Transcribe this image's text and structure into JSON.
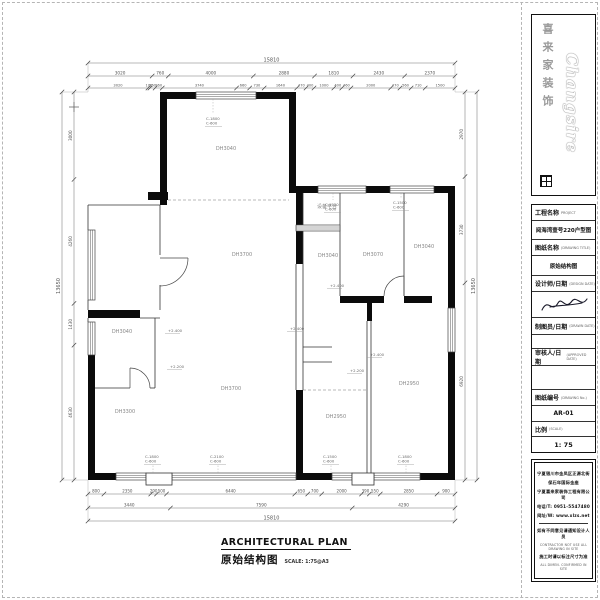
{
  "logo": {
    "brand_en": "Changsire",
    "brand_zh": "喜来家装饰"
  },
  "title_block": {
    "project_label": "工程名称",
    "project_label_en": "PROJECT",
    "project_value": "阅海湾壹号220户型图",
    "drawing_label": "图纸名称",
    "drawing_label_en": "(DRAWING TITLE)",
    "drawing_value": "原始结构图",
    "designer_label": "设计师/日期",
    "designer_label_en": "(DESIGN DATE)",
    "drafter_label": "制图员/日期",
    "drafter_label_en": "(DRAWN DATE)",
    "approver_label": "审核人/日期",
    "approver_label_en": "(APPROVED DATE)",
    "number_label": "图纸编号",
    "number_label_en": "(DRAWING No.)",
    "number_value": "AR-01",
    "scale_label": "比例",
    "scale_label_en": "(SCALE)",
    "scale_value": "1: 75"
  },
  "company": {
    "addr1": "宁夏银川市金凤区正源北街",
    "addr2": "保石年国际金座",
    "name": "宁夏喜来家装饰工程有限公司",
    "tel": "电话/T: 0951-5547480",
    "web": "网址/W: www.xlzs.net",
    "note1": "如有不同意见请通知设计人员",
    "note1_en": "CONTRACTOR NOT USE ALL DRAWING IN SITE",
    "note2": "施工时请以标注尺寸为准",
    "note2_en": "ALL DIMEN. CONFIRMED IN SITE"
  },
  "footer": {
    "title_en": "ARCHITECTURAL PLAN",
    "title_zh": "原始结构图",
    "scale_note": "SCALE: 1:75@A3"
  },
  "plan": {
    "rooms": [
      "DH3040",
      "DH3700",
      "设备平台",
      "DH3040",
      "DH3070",
      "DH3040",
      "DH3040",
      "DH3300",
      "DH3700",
      "DH2950",
      "DH2950"
    ],
    "window_tags": [
      [
        "C-1800",
        "C-600"
      ],
      [
        "C-1500",
        "C-600"
      ],
      [
        "C-1500",
        "C-600"
      ],
      [
        "C-1800",
        "C-600"
      ],
      [
        "C-2100",
        "C-600"
      ],
      [
        "C-1500",
        "C-600"
      ],
      [
        "C-1800",
        "C-600"
      ]
    ],
    "height_marks": [
      "+2.400",
      "+2.200",
      "+2.400",
      "+2.400",
      "+2.200",
      "+2.400"
    ],
    "dims": {
      "top_total": "15810",
      "top_row1": [
        "3020",
        "760",
        "4000",
        "2880",
        "1810",
        "2430",
        "2370"
      ],
      "top_row2": [
        "3020",
        "100",
        "260",
        "360",
        "3740",
        "660",
        "730",
        "1640",
        "470",
        "400",
        "1000",
        "400",
        "460",
        "2000",
        "470",
        "560",
        "710",
        "1500"
      ],
      "bottom_row1": [
        "800",
        "2350",
        "290",
        "500",
        "6440",
        "650",
        "700",
        "2000",
        "390",
        "550",
        "2850",
        "900"
      ],
      "bottom_row2": [
        "3440",
        "7590",
        "4290"
      ],
      "bottom_total": "15810",
      "left_col": [
        "3000",
        "4260",
        "1430",
        "4630"
      ],
      "left_total": "13650",
      "right_col": [
        "2970",
        "3730",
        "6920"
      ],
      "right_total": "13650"
    }
  }
}
